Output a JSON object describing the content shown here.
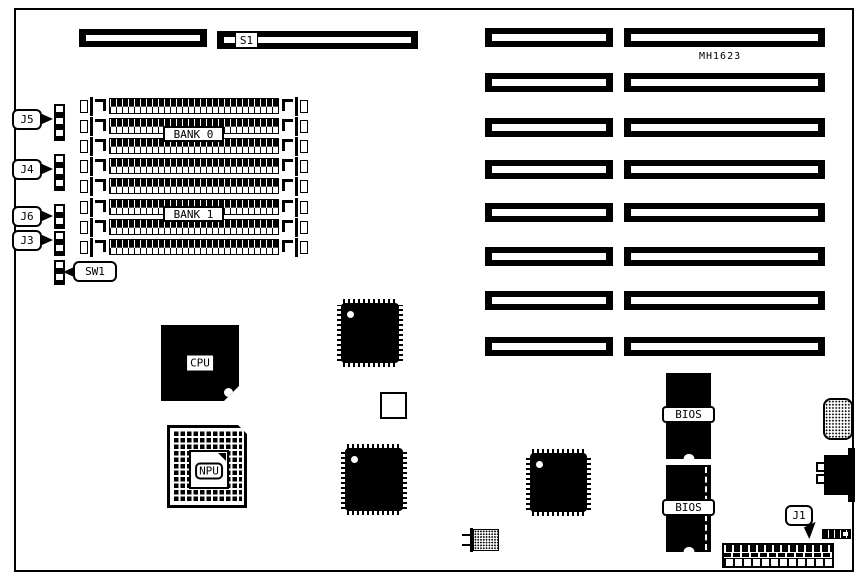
{
  "board": {
    "part_number": "MH1623",
    "ink_color": "#000000",
    "paper_color": "#ffffff"
  },
  "top_connectors": {
    "s1_label": "S1"
  },
  "memory": {
    "socket_count": 8,
    "bank0_label": "BANK 0",
    "bank1_label": "BANK 1"
  },
  "expansion_slots": {
    "row_count": 8
  },
  "callouts": {
    "j5": "J5",
    "j4": "J4",
    "j6": "J6",
    "j3": "J3",
    "sw1": "SW1",
    "j1": "J1"
  },
  "chips": {
    "cpu_label": "CPU",
    "npu_label": "NPU",
    "bios_top_label": "BIOS",
    "bios_bottom_label": "BIOS"
  }
}
